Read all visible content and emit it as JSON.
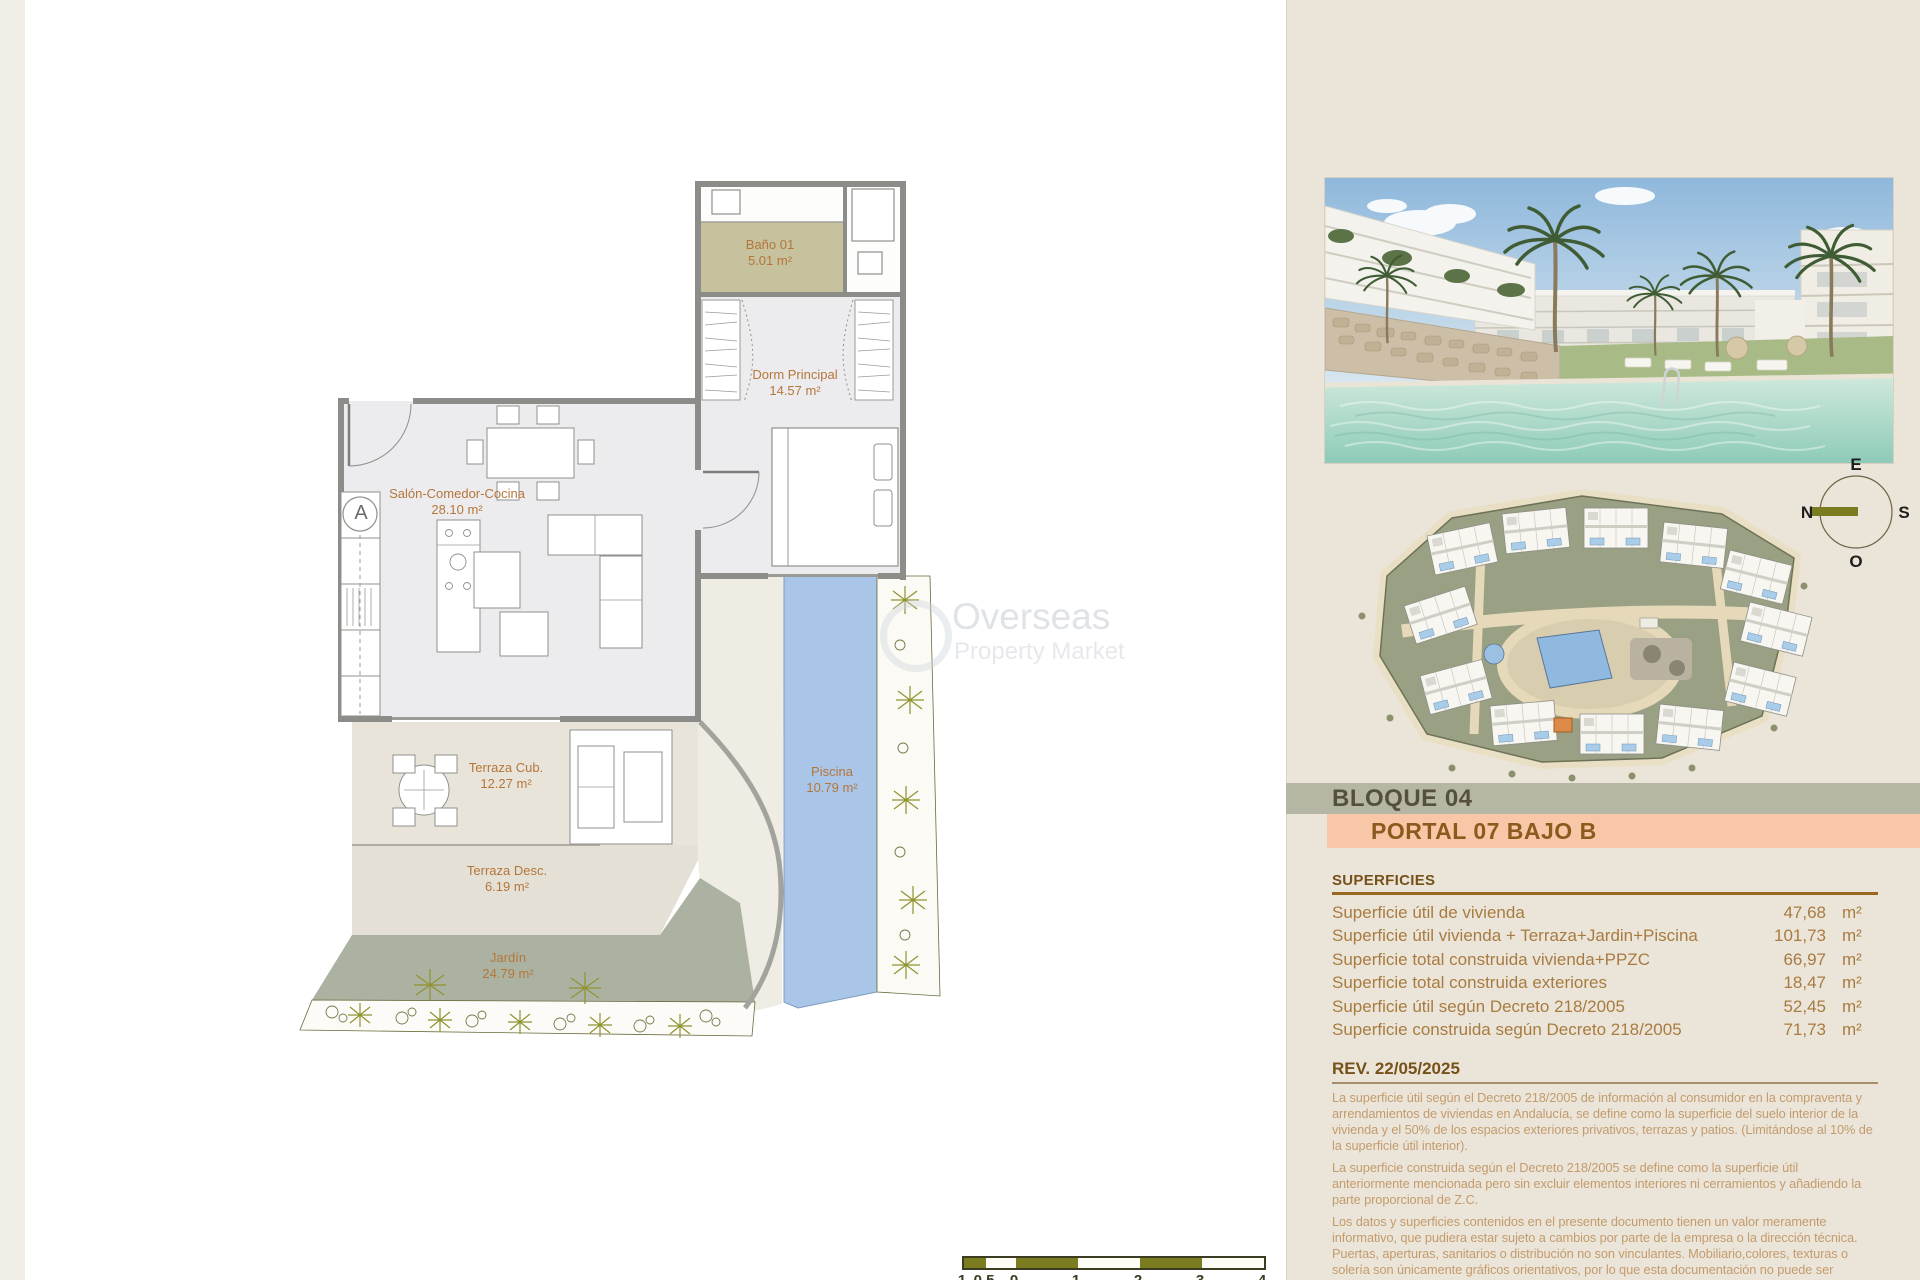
{
  "document": {
    "watermark": {
      "line1": "Overseas",
      "line2": "Property Market"
    },
    "floor_plan": {
      "entrance_marker": "A",
      "rooms": {
        "bano": {
          "name": "Baño 01",
          "area": "5.01 m²"
        },
        "dormitorio": {
          "name": "Dorm Principal",
          "area": "14.57 m²"
        },
        "salon": {
          "name": "Salón-Comedor-Cocina",
          "area": "28.10 m²"
        },
        "terraza_cub": {
          "name": "Terraza Cub.",
          "area": "12.27 m²"
        },
        "terraza_desc": {
          "name": "Terraza Desc.",
          "area": "6.19 m²"
        },
        "jardin": {
          "name": "Jardín",
          "area": "24.79 m²"
        },
        "piscina": {
          "name": "Piscina",
          "area": "10.79 m²"
        }
      },
      "scale_bar": {
        "labels": [
          "1",
          "0.5",
          "0",
          "1",
          "2",
          "3",
          "4"
        ]
      }
    },
    "compass": {
      "top": "E",
      "right": "S",
      "bottom": "O",
      "left": "N"
    },
    "block_header": "BLOQUE 04",
    "unit_header": "PORTAL 07 BAJO B",
    "superficies": {
      "title": "SUPERFICIES",
      "rows": [
        {
          "label": "Superficie útil de vivienda",
          "value": "47,68",
          "unit": "m²"
        },
        {
          "label": "Superficie útil vivienda + Terraza+Jardin+Piscina",
          "value": "101,73",
          "unit": "m²"
        },
        {
          "label": "Superficie total construida vivienda+PPZC",
          "value": "66,97",
          "unit": "m²"
        },
        {
          "label": "Superficie total construida exteriores",
          "value": "18,47",
          "unit": "m²"
        },
        {
          "label": "Superficie útil según Decreto 218/2005",
          "value": "52,45",
          "unit": "m²"
        },
        {
          "label": "Superficie construida según Decreto 218/2005",
          "value": "71,73",
          "unit": "m²"
        }
      ]
    },
    "revision": {
      "title": "REV. 22/05/2025",
      "paragraphs": [
        "La superficie útil según el Decreto 218/2005 de información al consumidor en la compraventa y arrendamientos de viviendas en Andalucía, se define como la superficie del suelo interior de la vivienda y el 50% de los espacios exteriores privativos, terrazas y patios. (Limitándose al 10% de la superficie útil interior).",
        "La superficie construida según el Decreto 218/2005 se define como la superficie útil anteriormente mencionada pero sin excluir elementos interiores ni cerramientos y añadiendo la parte proporcional de Z.C.",
        "Los datos y superficies contenidos en el presente documento tienen un valor meramente informativo, que pudiera estar sujeto a cambios por parte de la empresa o la dirección técnica. Puertas, aperturas, sanitarios o distribución no son vinculantes. Mobiliario,colores, texturas o solería son únicamente gráficos orientativos, por lo que esta documentación no puede ser considerada como una forma de"
      ]
    },
    "colors": {
      "panel_background": "#ebe5d9",
      "block_band": "#b6b6a4",
      "portal_band": "#f8c7a7",
      "heading_brown": "#7a551d",
      "table_text": "#a87b40",
      "plan_label_orange": "#b5763a",
      "pool_blue": "#a9c6e8",
      "garden_green": "#acb2a1",
      "bath_khaki": "#c6c29d",
      "scale_olive": "#7b7b20"
    }
  }
}
